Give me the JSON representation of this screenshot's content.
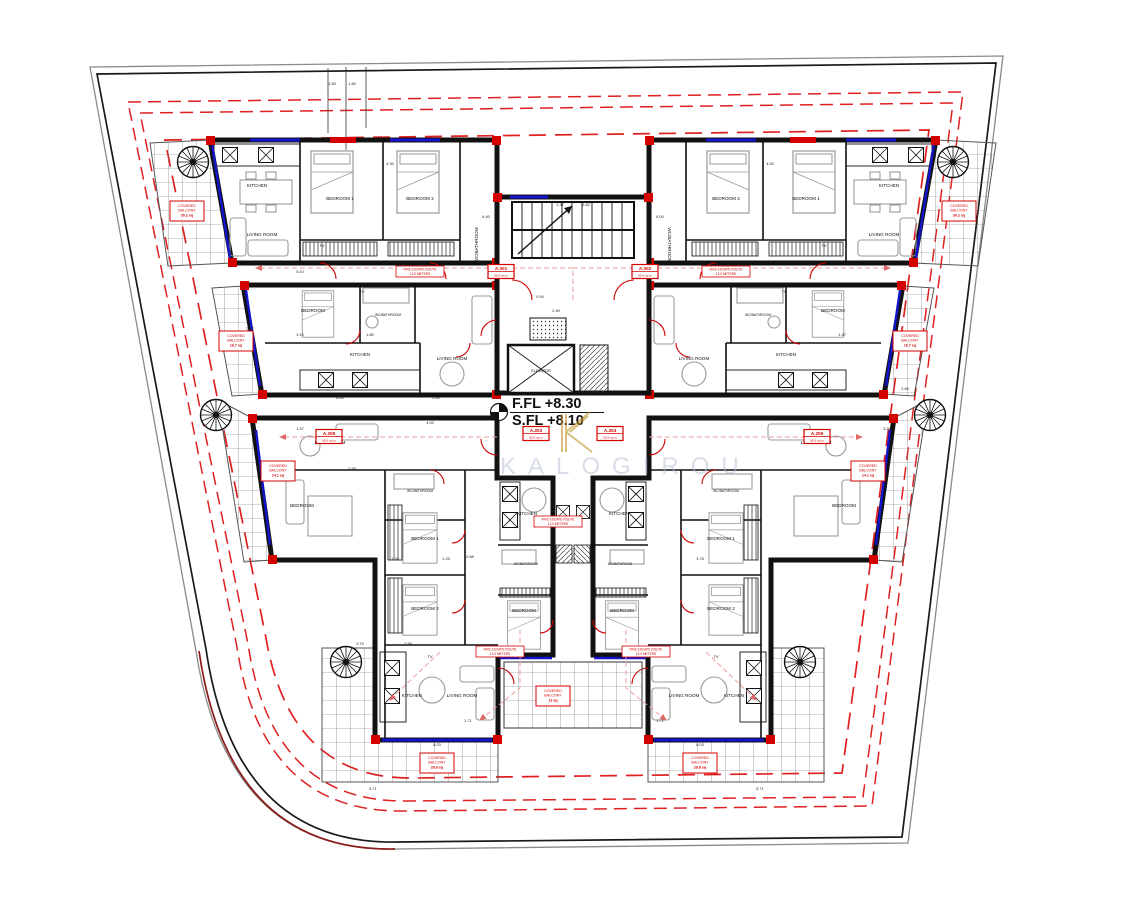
{
  "colors": {
    "wall": "#111111",
    "boundary_black": "#1a1a1a",
    "boundary_gray": "#8a8a8a",
    "boundary_maroon": "#8b1a1a",
    "setback_red": "#e02020",
    "accent_red": "#d40000",
    "escape_pink": "#ef9e9e",
    "glazing_blue": "#1414cc",
    "furniture_gray": "#9a9a9a",
    "watermark_gray": "#aebad0",
    "watermark_gold": "#bf922b"
  },
  "levels": {
    "ffl": "F.FL +8.30",
    "sfl": "S.FL +8.10"
  },
  "watermark": {
    "text": "KALOGIROU"
  },
  "core": {
    "elevator_label": "ELEVATOR"
  },
  "room_labels": [
    {
      "t": "KITCHEN",
      "x": 257,
      "y": 187
    },
    {
      "t": "LIVING ROOM",
      "x": 262,
      "y": 236
    },
    {
      "t": "BEDROOM 1",
      "x": 340,
      "y": 200
    },
    {
      "t": "BEDROOM 2",
      "x": 420,
      "y": 200
    },
    {
      "t": "WC/BATHROOM",
      "x": 478,
      "y": 245,
      "r": -90
    },
    {
      "t": "KITCHEN",
      "x": 889,
      "y": 187
    },
    {
      "t": "LIVING ROOM",
      "x": 884,
      "y": 236
    },
    {
      "t": "BEDROOM 1",
      "x": 806,
      "y": 200
    },
    {
      "t": "BEDROOM 2",
      "x": 726,
      "y": 200
    },
    {
      "t": "WC/BATHROOM",
      "x": 668,
      "y": 245,
      "r": 90
    },
    {
      "t": "BEDROOM",
      "x": 313,
      "y": 312
    },
    {
      "t": "WC/BATHROOM",
      "x": 388,
      "y": 316,
      "s": 3.4
    },
    {
      "t": "KITCHEN",
      "x": 360,
      "y": 356
    },
    {
      "t": "LIVING ROOM",
      "x": 452,
      "y": 360
    },
    {
      "t": "BEDROOM",
      "x": 833,
      "y": 312
    },
    {
      "t": "WC/BATHROOM",
      "x": 758,
      "y": 316,
      "s": 3.4
    },
    {
      "t": "KITCHEN",
      "x": 786,
      "y": 356
    },
    {
      "t": "LIVING ROOM",
      "x": 694,
      "y": 360
    },
    {
      "t": "LIVING ROOM",
      "x": 330,
      "y": 444
    },
    {
      "t": "BEDROOM",
      "x": 302,
      "y": 507
    },
    {
      "t": "WC/BATHROOM",
      "x": 420,
      "y": 492,
      "s": 3.4
    },
    {
      "t": "BEDROOM 1",
      "x": 425,
      "y": 540
    },
    {
      "t": "BEDROOM 2",
      "x": 425,
      "y": 610
    },
    {
      "t": "KITCHEN",
      "x": 527,
      "y": 515
    },
    {
      "t": "WC/BATHROOM",
      "x": 526,
      "y": 565,
      "s": 3.2
    },
    {
      "t": "BEDROOM",
      "x": 524,
      "y": 612
    },
    {
      "t": "LIVING ROOM",
      "x": 816,
      "y": 444
    },
    {
      "t": "BEDROOM",
      "x": 844,
      "y": 507
    },
    {
      "t": "WC/BATHROOM",
      "x": 726,
      "y": 492,
      "s": 3.4
    },
    {
      "t": "BEDROOM 1",
      "x": 721,
      "y": 540
    },
    {
      "t": "BEDROOM 2",
      "x": 721,
      "y": 610
    },
    {
      "t": "KITCHEN",
      "x": 619,
      "y": 515
    },
    {
      "t": "WC/BATHROOM",
      "x": 620,
      "y": 565,
      "s": 3.2
    },
    {
      "t": "BEDROOM",
      "x": 622,
      "y": 612
    },
    {
      "t": "KITCHEN",
      "x": 412,
      "y": 697
    },
    {
      "t": "LIVING ROOM",
      "x": 462,
      "y": 697
    },
    {
      "t": "KITCHEN",
      "x": 734,
      "y": 697
    },
    {
      "t": "LIVING ROOM",
      "x": 684,
      "y": 697
    }
  ],
  "tv_labels": [
    {
      "t": "TV",
      "x": 362,
      "y": 293
    },
    {
      "t": "TV",
      "x": 784,
      "y": 293
    },
    {
      "t": "TV",
      "x": 540,
      "y": 430
    },
    {
      "t": "TV",
      "x": 606,
      "y": 430
    },
    {
      "t": "TV",
      "x": 322,
      "y": 247
    },
    {
      "t": "TV",
      "x": 824,
      "y": 247
    },
    {
      "t": "TV",
      "x": 430,
      "y": 658
    },
    {
      "t": "TV",
      "x": 716,
      "y": 658
    }
  ],
  "balcony_tags": [
    {
      "l1": "COVERED",
      "l2": "BALCONY",
      "l3": "30.2 sq",
      "x": 187,
      "y": 210
    },
    {
      "l1": "COVERED",
      "l2": "BALCONY",
      "l3": "30.2 sq",
      "x": 959,
      "y": 210
    },
    {
      "l1": "COVERED",
      "l2": "BALCONY",
      "l3": "16.7 sq",
      "x": 236,
      "y": 340
    },
    {
      "l1": "COVERED",
      "l2": "BALCONY",
      "l3": "16.7 sq",
      "x": 910,
      "y": 340
    },
    {
      "l1": "COVERED",
      "l2": "BALCONY",
      "l3": "14.1 sq",
      "x": 278,
      "y": 470
    },
    {
      "l1": "COVERED",
      "l2": "BALCONY",
      "l3": "14.1 sq",
      "x": 868,
      "y": 470
    },
    {
      "l1": "COVERED",
      "l2": "BALCONY",
      "l3": "28.8 sq",
      "x": 437,
      "y": 762
    },
    {
      "l1": "COVERED",
      "l2": "BALCONY",
      "l3": "28.8 sq",
      "x": 700,
      "y": 762
    },
    {
      "l1": "COVERED",
      "l2": "BALCONY",
      "l3": "13 sq",
      "x": 553,
      "y": 695
    }
  ],
  "unit_tags": [
    {
      "no": "A.201",
      "area": "55.0 sq.m",
      "x": 501,
      "y": 271
    },
    {
      "no": "A.202",
      "area": "55.0 sq.m",
      "x": 645,
      "y": 271
    },
    {
      "no": "A.203",
      "area": "52.5 sq.m",
      "x": 536,
      "y": 433
    },
    {
      "no": "A.204",
      "area": "52.5 sq.m",
      "x": 610,
      "y": 433
    },
    {
      "no": "A.205",
      "area": "68.3 sq.m",
      "x": 329,
      "y": 436
    },
    {
      "no": "A.206",
      "area": "68.3 sq.m",
      "x": 817,
      "y": 436
    }
  ],
  "escape_tags": [
    {
      "l1": "FIRE ESCAPE ROUTE",
      "l2": "12.0 METERS",
      "x": 420,
      "y": 271
    },
    {
      "l1": "FIRE ESCAPE ROUTE",
      "l2": "12.0 METERS",
      "x": 726,
      "y": 271
    },
    {
      "l1": "FIRE ESCAPE ROUTE",
      "l2": "12.0 METERS",
      "x": 558,
      "y": 521
    },
    {
      "l1": "FIRE ESCAPE ROUTE",
      "l2": "12.0 METERS",
      "x": 500,
      "y": 651
    },
    {
      "l1": "FIRE ESCAPE ROUTE",
      "l2": "12.0 METERS",
      "x": 646,
      "y": 651
    }
  ],
  "dims": [
    {
      "t": "1.50",
      "x": 332,
      "y": 85
    },
    {
      "t": "1.80",
      "x": 352,
      "y": 85
    },
    {
      "t": "5.10",
      "x": 300,
      "y": 273
    },
    {
      "t": "1.50",
      "x": 412,
      "y": 277
    },
    {
      "t": "0.90",
      "x": 540,
      "y": 298
    },
    {
      "t": "2.90",
      "x": 556,
      "y": 312
    },
    {
      "t": "2.47",
      "x": 250,
      "y": 330
    },
    {
      "t": "3.10",
      "x": 300,
      "y": 336
    },
    {
      "t": "1.80",
      "x": 370,
      "y": 336
    },
    {
      "t": "2.40",
      "x": 436,
      "y": 399
    },
    {
      "t": "6.50",
      "x": 340,
      "y": 399
    },
    {
      "t": "1.57",
      "x": 300,
      "y": 430
    },
    {
      "t": "4.02",
      "x": 430,
      "y": 424
    },
    {
      "t": "4.80",
      "x": 260,
      "y": 470
    },
    {
      "t": "3.85",
      "x": 352,
      "y": 470
    },
    {
      "t": "1.20",
      "x": 395,
      "y": 560
    },
    {
      "t": "0.88",
      "x": 470,
      "y": 558
    },
    {
      "t": "2.90",
      "x": 408,
      "y": 645
    },
    {
      "t": "0.70",
      "x": 360,
      "y": 645
    },
    {
      "t": "8.03",
      "x": 437,
      "y": 746
    },
    {
      "t": "1.71",
      "x": 468,
      "y": 722
    },
    {
      "t": "5.71",
      "x": 373,
      "y": 790
    },
    {
      "t": "5.71",
      "x": 760,
      "y": 790
    },
    {
      "t": "1.40",
      "x": 522,
      "y": 659
    },
    {
      "t": "1.40",
      "x": 620,
      "y": 659
    },
    {
      "t": "8.03",
      "x": 700,
      "y": 746
    },
    {
      "t": "1.71",
      "x": 660,
      "y": 722
    },
    {
      "t": "1.47",
      "x": 842,
      "y": 336
    },
    {
      "t": "3.20",
      "x": 887,
      "y": 430
    },
    {
      "t": "2.80",
      "x": 905,
      "y": 390
    },
    {
      "t": "4.52",
      "x": 770,
      "y": 165
    },
    {
      "t": "4.30",
      "x": 390,
      "y": 165
    },
    {
      "t": "6.40",
      "x": 486,
      "y": 218
    },
    {
      "t": "8.00",
      "x": 660,
      "y": 218
    },
    {
      "t": "2.37",
      "x": 560,
      "y": 206
    },
    {
      "t": "2.82",
      "x": 586,
      "y": 206
    },
    {
      "t": "3.78",
      "x": 700,
      "y": 560
    },
    {
      "t": "1.25",
      "x": 446,
      "y": 560
    }
  ]
}
